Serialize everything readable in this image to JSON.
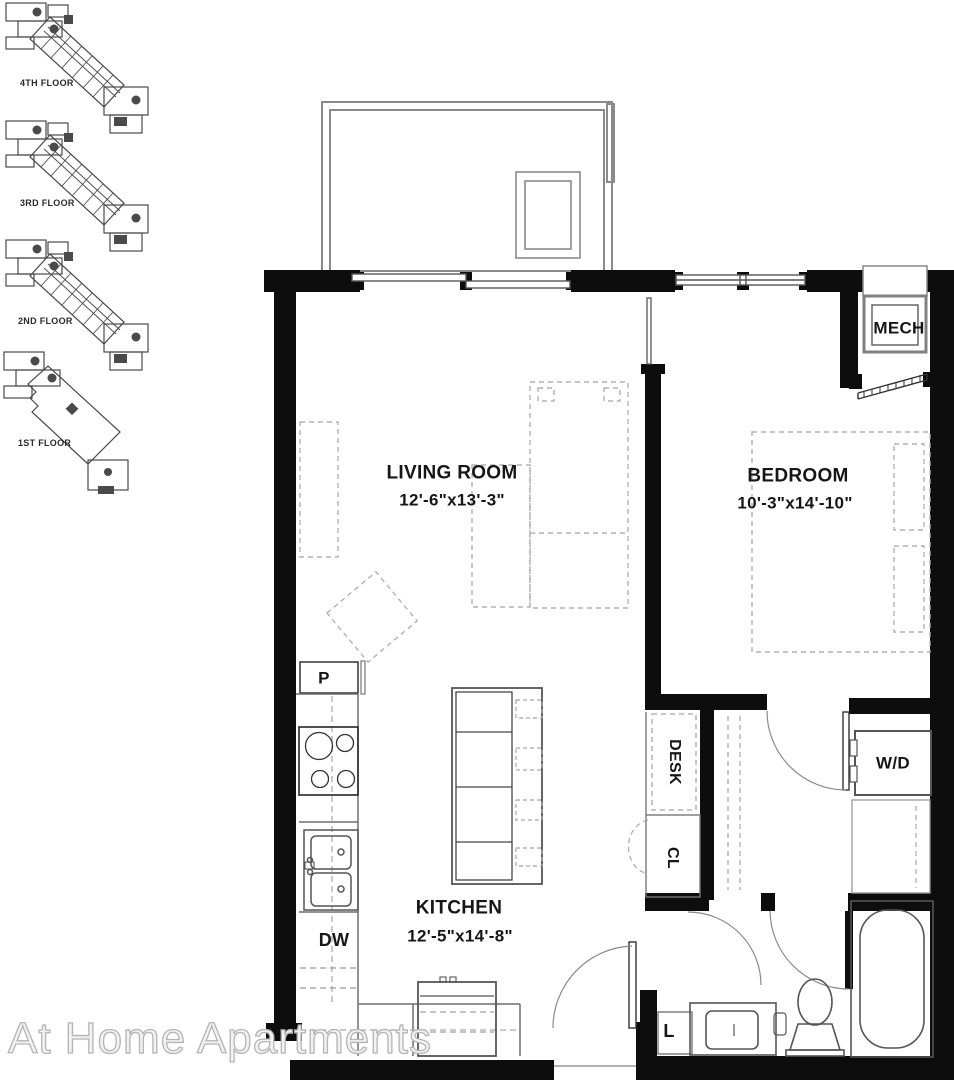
{
  "watermark": "At Home Apartments",
  "key_plans": {
    "items": [
      {
        "label": "4TH FLOOR"
      },
      {
        "label": "3RD FLOOR"
      },
      {
        "label": "2ND FLOOR"
      },
      {
        "label": "1ST FLOOR"
      }
    ]
  },
  "plan": {
    "rooms": [
      {
        "id": "living",
        "name": "LIVING ROOM",
        "dims": "12'-6\"x13'-3\""
      },
      {
        "id": "bedroom",
        "name": "BEDROOM",
        "dims": "10'-3\"x14'-10\""
      },
      {
        "id": "kitchen",
        "name": "KITCHEN",
        "dims": "12'-5\"x14'-8\""
      }
    ],
    "fixtures": {
      "mech": "MECH",
      "desk": "DESK",
      "closet": "CL",
      "washer_dryer": "W/D",
      "pantry": "P",
      "dishwasher": "DW",
      "linen": "L"
    },
    "colors": {
      "wall": "#0d0d0d",
      "line": "#5f5f5f",
      "light_line": "#8a8a8a",
      "dash": "#b2b2b2",
      "watermark": "#b5b5b5"
    }
  }
}
